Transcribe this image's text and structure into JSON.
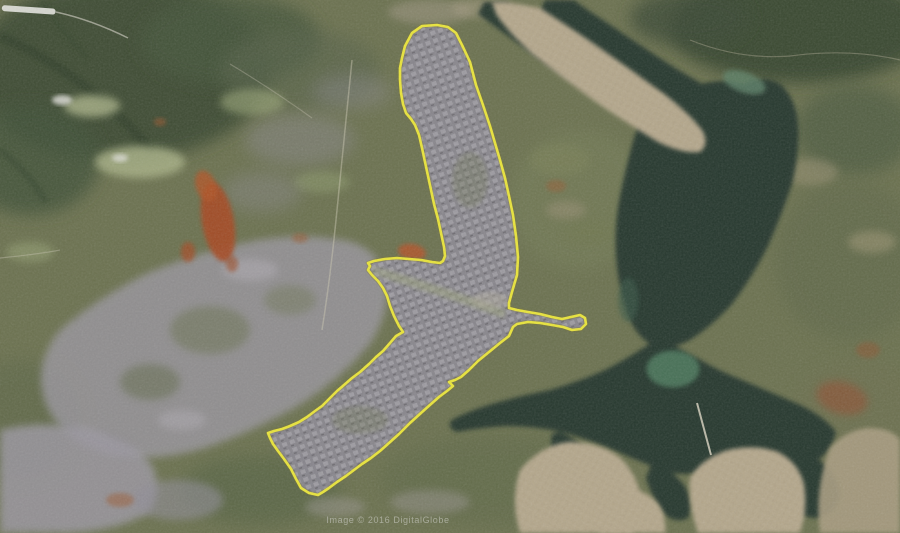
{
  "map": {
    "watermark": "Image © 2016 DigitalGlobe",
    "colors": {
      "land": "#6b714f",
      "forest": "#3a4a33",
      "water": "#26392e",
      "water_shallow": "#4e7a5e",
      "urban": "#8e8b95",
      "suburb": "#b2a58a",
      "soil": "#a64820",
      "road": "#cfc9b4",
      "outline": "#e9e43a",
      "watermark_text": "#d8d8d4"
    },
    "overlay": {
      "label": "city-plan-boundary",
      "color": "#e9e43a",
      "points": [
        [
          402,
          58
        ],
        [
          405,
          46
        ],
        [
          412,
          33
        ],
        [
          422,
          26
        ],
        [
          437,
          25
        ],
        [
          448,
          27
        ],
        [
          456,
          33
        ],
        [
          463,
          47
        ],
        [
          470,
          62
        ],
        [
          476,
          85
        ],
        [
          483,
          105
        ],
        [
          490,
          126
        ],
        [
          495,
          143
        ],
        [
          500,
          160
        ],
        [
          505,
          178
        ],
        [
          509,
          196
        ],
        [
          513,
          215
        ],
        [
          516,
          236
        ],
        [
          518,
          257
        ],
        [
          517,
          275
        ],
        [
          512,
          292
        ],
        [
          509,
          303
        ],
        [
          509,
          308
        ],
        [
          517,
          310
        ],
        [
          528,
          312
        ],
        [
          540,
          314
        ],
        [
          552,
          317
        ],
        [
          562,
          319
        ],
        [
          571,
          317
        ],
        [
          580,
          315
        ],
        [
          585,
          318
        ],
        [
          586,
          324
        ],
        [
          581,
          329
        ],
        [
          572,
          330
        ],
        [
          563,
          327
        ],
        [
          552,
          325
        ],
        [
          540,
          323
        ],
        [
          528,
          322
        ],
        [
          517,
          324
        ],
        [
          513,
          327
        ],
        [
          509,
          336
        ],
        [
          500,
          343
        ],
        [
          489,
          352
        ],
        [
          478,
          361
        ],
        [
          469,
          370
        ],
        [
          461,
          377
        ],
        [
          455,
          380
        ],
        [
          449,
          382
        ],
        [
          453,
          386
        ],
        [
          447,
          391
        ],
        [
          439,
          397
        ],
        [
          431,
          404
        ],
        [
          421,
          413
        ],
        [
          410,
          423
        ],
        [
          399,
          434
        ],
        [
          389,
          443
        ],
        [
          380,
          451
        ],
        [
          371,
          458
        ],
        [
          362,
          464
        ],
        [
          354,
          470
        ],
        [
          346,
          476
        ],
        [
          337,
          482
        ],
        [
          329,
          488
        ],
        [
          323,
          492
        ],
        [
          318,
          495
        ],
        [
          309,
          493
        ],
        [
          301,
          488
        ],
        [
          296,
          479
        ],
        [
          291,
          469
        ],
        [
          284,
          459
        ],
        [
          278,
          451
        ],
        [
          273,
          444
        ],
        [
          270,
          438
        ],
        [
          268,
          433
        ],
        [
          274,
          431
        ],
        [
          282,
          429
        ],
        [
          290,
          426
        ],
        [
          299,
          422
        ],
        [
          307,
          417
        ],
        [
          315,
          411
        ],
        [
          322,
          406
        ],
        [
          329,
          399
        ],
        [
          337,
          391
        ],
        [
          344,
          385
        ],
        [
          352,
          378
        ],
        [
          360,
          372
        ],
        [
          369,
          364
        ],
        [
          376,
          357
        ],
        [
          383,
          351
        ],
        [
          390,
          343
        ],
        [
          396,
          336
        ],
        [
          403,
          332
        ],
        [
          399,
          326
        ],
        [
          394,
          316
        ],
        [
          390,
          306
        ],
        [
          387,
          296
        ],
        [
          383,
          288
        ],
        [
          378,
          281
        ],
        [
          372,
          275
        ],
        [
          368,
          270
        ],
        [
          370,
          266
        ],
        [
          368,
          263
        ],
        [
          374,
          261
        ],
        [
          385,
          259
        ],
        [
          397,
          258
        ],
        [
          409,
          259
        ],
        [
          421,
          260
        ],
        [
          432,
          262
        ],
        [
          440,
          263
        ],
        [
          443,
          261
        ],
        [
          445,
          256
        ],
        [
          444,
          247
        ],
        [
          441,
          233
        ],
        [
          438,
          219
        ],
        [
          434,
          204
        ],
        [
          431,
          190
        ],
        [
          428,
          176
        ],
        [
          425,
          162
        ],
        [
          422,
          148
        ],
        [
          419,
          135
        ],
        [
          415,
          125
        ],
        [
          411,
          119
        ],
        [
          406,
          113
        ],
        [
          403,
          104
        ],
        [
          401,
          93
        ],
        [
          400,
          80
        ],
        [
          400,
          68
        ],
        [
          402,
          58
        ]
      ]
    }
  }
}
